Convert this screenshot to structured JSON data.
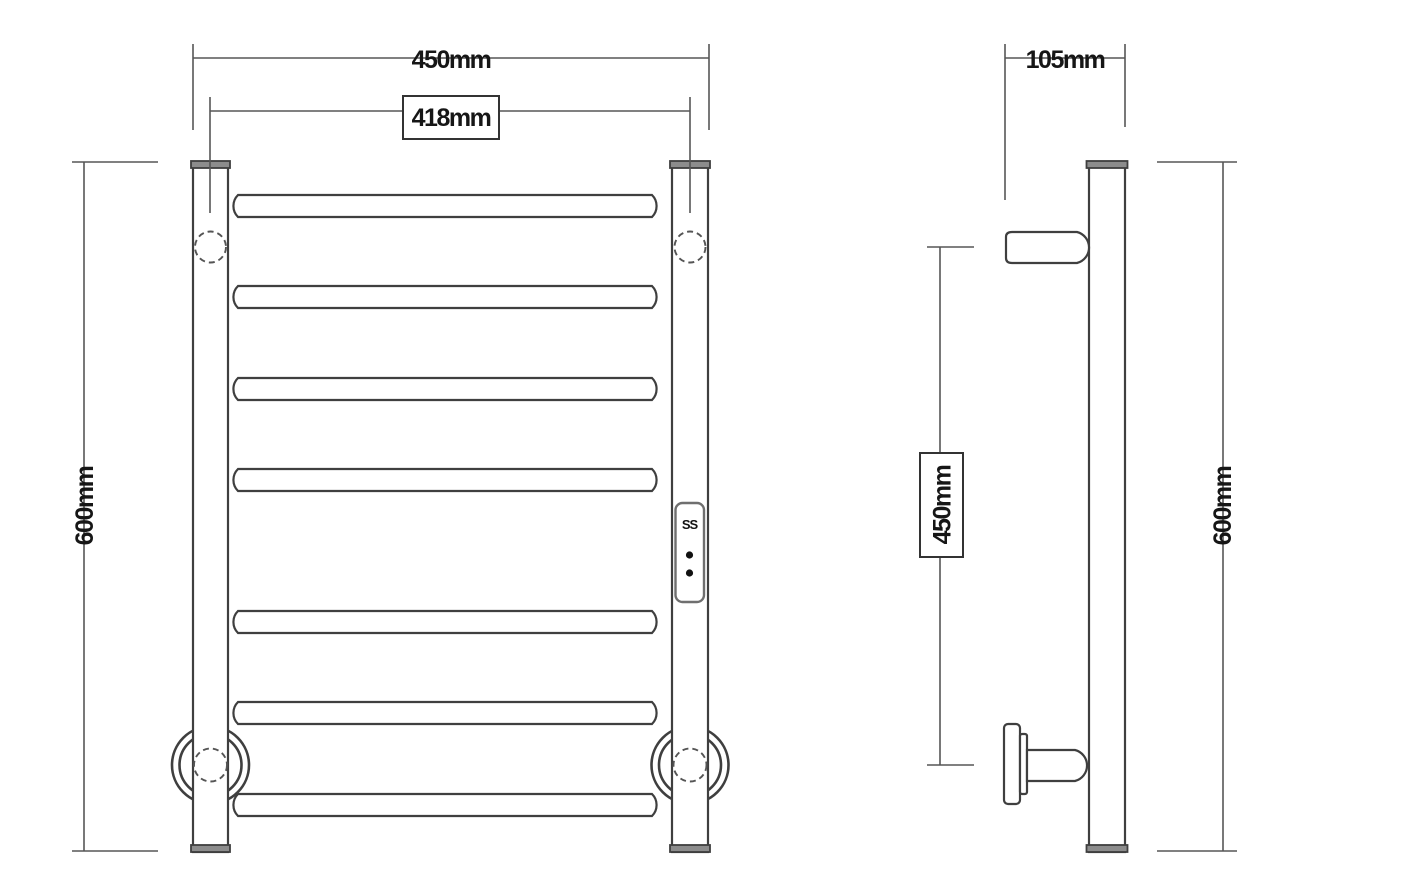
{
  "colors": {
    "background": "#ffffff",
    "object_line": "#3f3f3f",
    "dimension_line": "#565656",
    "cap_fill": "#8c8c8c",
    "text": "#161616"
  },
  "front_view": {
    "dim_overall_width": "450mm",
    "dim_rail_spacing": "418mm",
    "dim_height": "600mm",
    "rung_count": 7,
    "control_panel": {
      "label": "SS",
      "dot_count": 2
    }
  },
  "side_view": {
    "dim_depth": "105mm",
    "dim_bracket_spacing": "450mm",
    "dim_height": "600mm"
  }
}
